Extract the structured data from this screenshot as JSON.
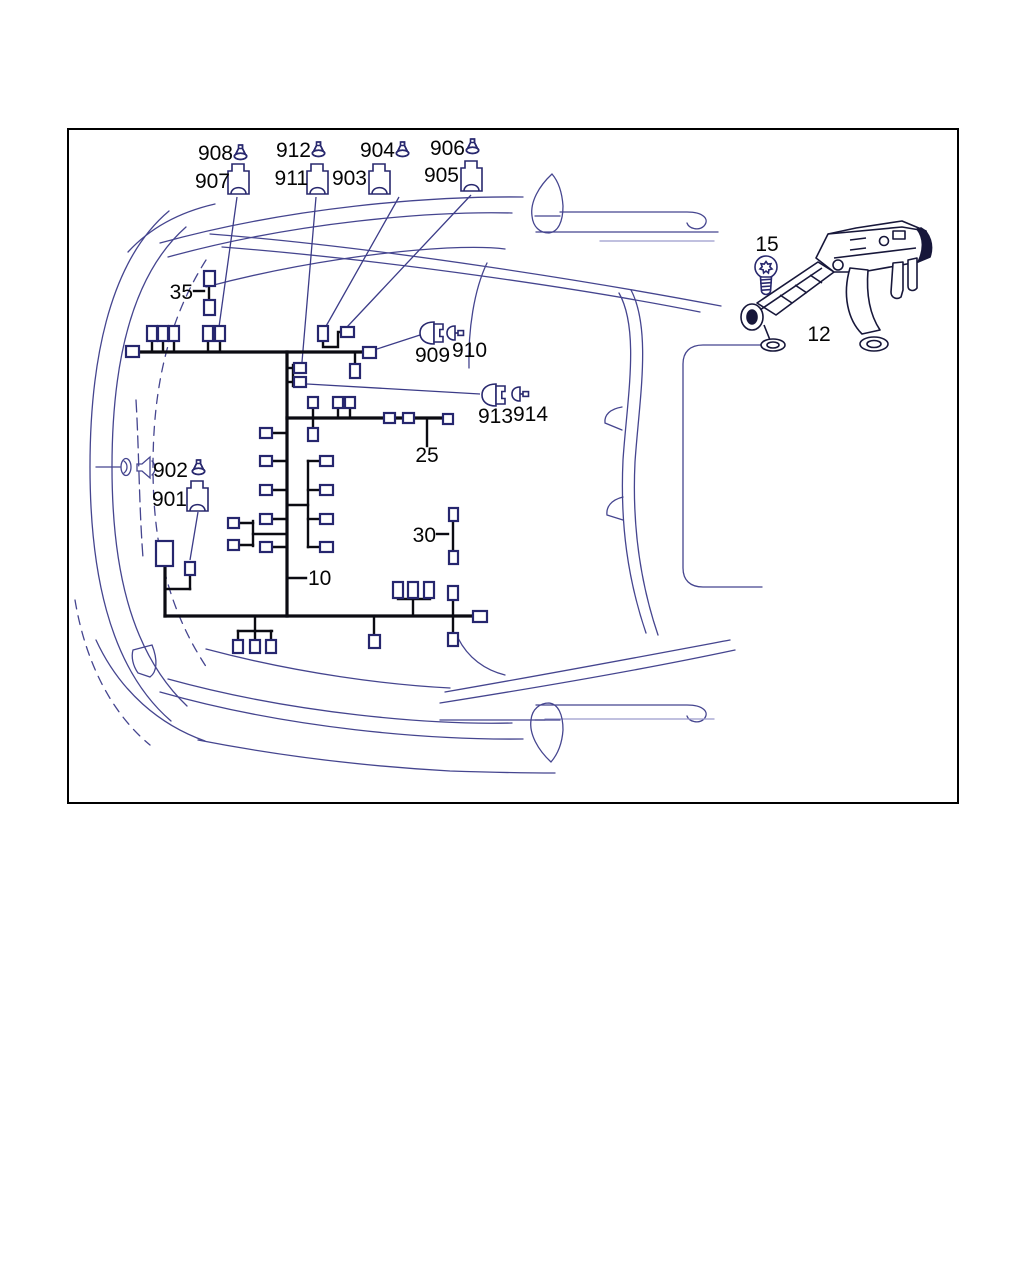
{
  "page": {
    "width": 1024,
    "height": 1280,
    "background": "#ffffff"
  },
  "frame": {
    "x": 68,
    "y": 129,
    "width": 890,
    "height": 674,
    "border_color": "#000000",
    "border_width": 2
  },
  "colors": {
    "harness": "#0b0b12",
    "connector_stroke": "#26266e",
    "connector_fill": "#ffffff",
    "leader": "#3c3c88",
    "car_outline": "#45458f",
    "car_outline_faint": "#9b9bcc",
    "icon_stroke": "#28286e",
    "label_text": "#050505",
    "bracket_stroke": "#17173a"
  },
  "labels": [
    {
      "id": "908",
      "text": "908",
      "x": 233,
      "y": 160,
      "anchor": "end"
    },
    {
      "id": "907",
      "text": "907",
      "x": 230,
      "y": 188,
      "anchor": "end"
    },
    {
      "id": "912",
      "text": "912",
      "x": 311,
      "y": 157,
      "anchor": "end"
    },
    {
      "id": "911",
      "text": "911",
      "x": 308,
      "y": 185,
      "anchor": "end"
    },
    {
      "id": "904",
      "text": "904",
      "x": 395,
      "y": 157,
      "anchor": "end"
    },
    {
      "id": "903",
      "text": "903",
      "x": 367,
      "y": 185,
      "anchor": "end"
    },
    {
      "id": "906",
      "text": "906",
      "x": 465,
      "y": 155,
      "anchor": "end"
    },
    {
      "id": "905",
      "text": "905",
      "x": 459,
      "y": 182,
      "anchor": "end"
    },
    {
      "id": "35",
      "text": "35",
      "x": 193,
      "y": 299,
      "anchor": "end"
    },
    {
      "id": "909",
      "text": "909",
      "x": 415,
      "y": 362,
      "anchor": "start"
    },
    {
      "id": "910",
      "text": "910",
      "x": 452,
      "y": 357,
      "anchor": "start"
    },
    {
      "id": "913",
      "text": "913",
      "x": 478,
      "y": 423,
      "anchor": "start"
    },
    {
      "id": "914",
      "text": "914",
      "x": 513,
      "y": 421,
      "anchor": "start"
    },
    {
      "id": "25",
      "text": "25",
      "x": 427,
      "y": 462,
      "anchor": "middle"
    },
    {
      "id": "902",
      "text": "902",
      "x": 188,
      "y": 477,
      "anchor": "end"
    },
    {
      "id": "901",
      "text": "901",
      "x": 187,
      "y": 506,
      "anchor": "end"
    },
    {
      "id": "30",
      "text": "30",
      "x": 436,
      "y": 542,
      "anchor": "end"
    },
    {
      "id": "10",
      "text": "10",
      "x": 308,
      "y": 585,
      "anchor": "start"
    },
    {
      "id": "15",
      "text": "15",
      "x": 767,
      "y": 251,
      "anchor": "middle"
    },
    {
      "id": "12",
      "text": "12",
      "x": 819,
      "y": 341,
      "anchor": "middle"
    }
  ],
  "harness": {
    "main_wires": [
      [
        [
          132,
          352
        ],
        [
          375,
          352
        ]
      ],
      [
        [
          287,
          352
        ],
        [
          287,
          616
        ]
      ],
      [
        [
          287,
          418
        ],
        [
          452,
          418
        ]
      ],
      [
        [
          165,
          616
        ],
        [
          480,
          616
        ]
      ],
      [
        [
          165,
          566
        ],
        [
          165,
          616
        ]
      ]
    ],
    "stub_wires": [
      [
        [
          152,
          341
        ],
        [
          152,
          352
        ]
      ],
      [
        [
          163,
          341
        ],
        [
          163,
          352
        ]
      ],
      [
        [
          174,
          341
        ],
        [
          174,
          352
        ]
      ],
      [
        [
          208,
          341
        ],
        [
          208,
          352
        ]
      ],
      [
        [
          220,
          341
        ],
        [
          220,
          352
        ]
      ],
      [
        [
          209,
          286
        ],
        [
          209,
          301
        ]
      ],
      [
        [
          194,
          291
        ],
        [
          204,
          291
        ]
      ],
      [
        [
          323,
          341
        ],
        [
          323,
          347
        ],
        [
          338,
          347
        ],
        [
          338,
          332
        ],
        [
          341,
          332
        ]
      ],
      [
        [
          355,
          352
        ],
        [
          355,
          364
        ]
      ],
      [
        [
          287,
          368
        ],
        [
          294,
          368
        ]
      ],
      [
        [
          287,
          382
        ],
        [
          294,
          382
        ]
      ],
      [
        [
          293,
          365
        ],
        [
          293,
          386
        ]
      ],
      [
        [
          313,
          408
        ],
        [
          313,
          428
        ]
      ],
      [
        [
          338,
          408
        ],
        [
          338,
          418
        ]
      ],
      [
        [
          350,
          408
        ],
        [
          350,
          418
        ]
      ],
      [
        [
          427,
          418
        ],
        [
          427,
          446
        ]
      ],
      [
        [
          272,
          433
        ],
        [
          287,
          433
        ]
      ],
      [
        [
          272,
          461
        ],
        [
          287,
          461
        ]
      ],
      [
        [
          272,
          490
        ],
        [
          287,
          490
        ]
      ],
      [
        [
          272,
          519
        ],
        [
          287,
          519
        ]
      ],
      [
        [
          272,
          547
        ],
        [
          287,
          547
        ]
      ],
      [
        [
          238,
          523
        ],
        [
          253,
          523
        ]
      ],
      [
        [
          238,
          545
        ],
        [
          253,
          545
        ]
      ],
      [
        [
          253,
          521
        ],
        [
          253,
          546
        ]
      ],
      [
        [
          253,
          534
        ],
        [
          287,
          534
        ]
      ],
      [
        [
          308,
          461
        ],
        [
          308,
          547
        ]
      ],
      [
        [
          287,
          505
        ],
        [
          308,
          505
        ]
      ],
      [
        [
          308,
          461
        ],
        [
          320,
          461
        ]
      ],
      [
        [
          308,
          490
        ],
        [
          320,
          490
        ]
      ],
      [
        [
          308,
          519
        ],
        [
          320,
          519
        ]
      ],
      [
        [
          308,
          547
        ],
        [
          320,
          547
        ]
      ],
      [
        [
          453,
          521
        ],
        [
          453,
          551
        ]
      ],
      [
        [
          437,
          534
        ],
        [
          448,
          534
        ]
      ],
      [
        [
          288,
          578
        ],
        [
          306,
          578
        ]
      ],
      [
        [
          165,
          589
        ],
        [
          190,
          589
        ]
      ],
      [
        [
          190,
          574
        ],
        [
          190,
          589
        ]
      ],
      [
        [
          255,
          616
        ],
        [
          255,
          631
        ]
      ],
      [
        [
          238,
          631
        ],
        [
          272,
          631
        ]
      ],
      [
        [
          238,
          631
        ],
        [
          238,
          640
        ]
      ],
      [
        [
          255,
          631
        ],
        [
          255,
          640
        ]
      ],
      [
        [
          271,
          631
        ],
        [
          271,
          640
        ]
      ],
      [
        [
          374,
          616
        ],
        [
          374,
          635
        ]
      ],
      [
        [
          413,
          599
        ],
        [
          413,
          616
        ]
      ],
      [
        [
          398,
          599
        ],
        [
          430,
          599
        ]
      ],
      [
        [
          453,
          600
        ],
        [
          453,
          616
        ]
      ],
      [
        [
          453,
          616
        ],
        [
          453,
          633
        ]
      ]
    ],
    "connectors": [
      {
        "x": 147,
        "y": 326,
        "w": 10,
        "h": 15
      },
      {
        "x": 158,
        "y": 326,
        "w": 10,
        "h": 15
      },
      {
        "x": 169,
        "y": 326,
        "w": 10,
        "h": 15
      },
      {
        "x": 203,
        "y": 326,
        "w": 10,
        "h": 15
      },
      {
        "x": 215,
        "y": 326,
        "w": 10,
        "h": 15
      },
      {
        "x": 204,
        "y": 271,
        "w": 11,
        "h": 15
      },
      {
        "x": 204,
        "y": 300,
        "w": 11,
        "h": 15
      },
      {
        "x": 318,
        "y": 326,
        "w": 10,
        "h": 15
      },
      {
        "x": 341,
        "y": 327,
        "w": 13,
        "h": 10
      },
      {
        "x": 350,
        "y": 364,
        "w": 10,
        "h": 14
      },
      {
        "x": 126,
        "y": 346,
        "w": 13,
        "h": 11
      },
      {
        "x": 363,
        "y": 347,
        "w": 13,
        "h": 11
      },
      {
        "x": 294,
        "y": 363,
        "w": 12,
        "h": 10
      },
      {
        "x": 294,
        "y": 377,
        "w": 12,
        "h": 10
      },
      {
        "x": 308,
        "y": 397,
        "w": 10,
        "h": 11
      },
      {
        "x": 333,
        "y": 397,
        "w": 10,
        "h": 11
      },
      {
        "x": 345,
        "y": 397,
        "w": 10,
        "h": 11
      },
      {
        "x": 308,
        "y": 428,
        "w": 10,
        "h": 13
      },
      {
        "x": 384,
        "y": 413,
        "w": 11,
        "h": 10
      },
      {
        "x": 403,
        "y": 413,
        "w": 11,
        "h": 10
      },
      {
        "x": 443,
        "y": 414,
        "w": 10,
        "h": 10
      },
      {
        "x": 260,
        "y": 428,
        "w": 12,
        "h": 10
      },
      {
        "x": 260,
        "y": 456,
        "w": 12,
        "h": 10
      },
      {
        "x": 260,
        "y": 485,
        "w": 12,
        "h": 10
      },
      {
        "x": 260,
        "y": 514,
        "w": 12,
        "h": 10
      },
      {
        "x": 260,
        "y": 542,
        "w": 12,
        "h": 10
      },
      {
        "x": 228,
        "y": 518,
        "w": 11,
        "h": 10
      },
      {
        "x": 228,
        "y": 540,
        "w": 11,
        "h": 10
      },
      {
        "x": 320,
        "y": 456,
        "w": 13,
        "h": 10
      },
      {
        "x": 320,
        "y": 485,
        "w": 13,
        "h": 10
      },
      {
        "x": 320,
        "y": 514,
        "w": 13,
        "h": 10
      },
      {
        "x": 320,
        "y": 542,
        "w": 13,
        "h": 10
      },
      {
        "x": 449,
        "y": 508,
        "w": 9,
        "h": 13
      },
      {
        "x": 449,
        "y": 551,
        "w": 9,
        "h": 13
      },
      {
        "x": 156,
        "y": 541,
        "w": 17,
        "h": 25
      },
      {
        "x": 185,
        "y": 562,
        "w": 10,
        "h": 13
      },
      {
        "x": 233,
        "y": 640,
        "w": 10,
        "h": 13
      },
      {
        "x": 250,
        "y": 640,
        "w": 10,
        "h": 13
      },
      {
        "x": 266,
        "y": 640,
        "w": 10,
        "h": 13
      },
      {
        "x": 369,
        "y": 635,
        "w": 11,
        "h": 13
      },
      {
        "x": 393,
        "y": 582,
        "w": 10,
        "h": 16
      },
      {
        "x": 408,
        "y": 582,
        "w": 10,
        "h": 16
      },
      {
        "x": 424,
        "y": 582,
        "w": 10,
        "h": 16
      },
      {
        "x": 448,
        "y": 586,
        "w": 10,
        "h": 14
      },
      {
        "x": 448,
        "y": 633,
        "w": 10,
        "h": 13
      },
      {
        "x": 473,
        "y": 611,
        "w": 14,
        "h": 11
      }
    ]
  },
  "leaders": [
    {
      "x1": 237,
      "y1": 197,
      "x2": 219,
      "y2": 327
    },
    {
      "x1": 316,
      "y1": 197,
      "x2": 302,
      "y2": 362
    },
    {
      "x1": 399,
      "y1": 197,
      "x2": 325,
      "y2": 328
    },
    {
      "x1": 471,
      "y1": 195,
      "x2": 347,
      "y2": 327
    },
    {
      "x1": 377,
      "y1": 349,
      "x2": 420,
      "y2": 335
    },
    {
      "x1": 307,
      "y1": 384,
      "x2": 480,
      "y2": 394
    },
    {
      "x1": 198,
      "y1": 512,
      "x2": 190,
      "y2": 560
    }
  ],
  "icons": [
    {
      "type": "lamp",
      "name": "bulb-icon-908",
      "x": 234,
      "y": 145
    },
    {
      "type": "lamp",
      "name": "bulb-icon-912",
      "x": 312,
      "y": 142
    },
    {
      "type": "lamp",
      "name": "bulb-icon-904",
      "x": 396,
      "y": 142
    },
    {
      "type": "lamp",
      "name": "bulb-icon-906",
      "x": 466,
      "y": 139
    },
    {
      "type": "lamp",
      "name": "bulb-icon-902",
      "x": 192,
      "y": 460
    },
    {
      "type": "housing",
      "name": "connector-housing-icon-907",
      "x": 228,
      "y": 164
    },
    {
      "type": "housing",
      "name": "connector-housing-icon-911",
      "x": 307,
      "y": 164
    },
    {
      "type": "housing",
      "name": "connector-housing-icon-903",
      "x": 369,
      "y": 164
    },
    {
      "type": "housing",
      "name": "connector-housing-icon-905",
      "x": 461,
      "y": 161
    },
    {
      "type": "housing",
      "name": "connector-housing-icon-901",
      "x": 187,
      "y": 481
    },
    {
      "type": "dconn",
      "name": "socket-icon-909",
      "x": 419,
      "y": 322
    },
    {
      "type": "dconn",
      "name": "socket-icon-913",
      "x": 481,
      "y": 384
    },
    {
      "type": "plug",
      "name": "plug-icon-910",
      "x": 446,
      "y": 326
    },
    {
      "type": "plug",
      "name": "plug-icon-914",
      "x": 511,
      "y": 387
    },
    {
      "type": "screw",
      "name": "torx-screw-icon-15",
      "x": 753,
      "y": 255
    }
  ]
}
